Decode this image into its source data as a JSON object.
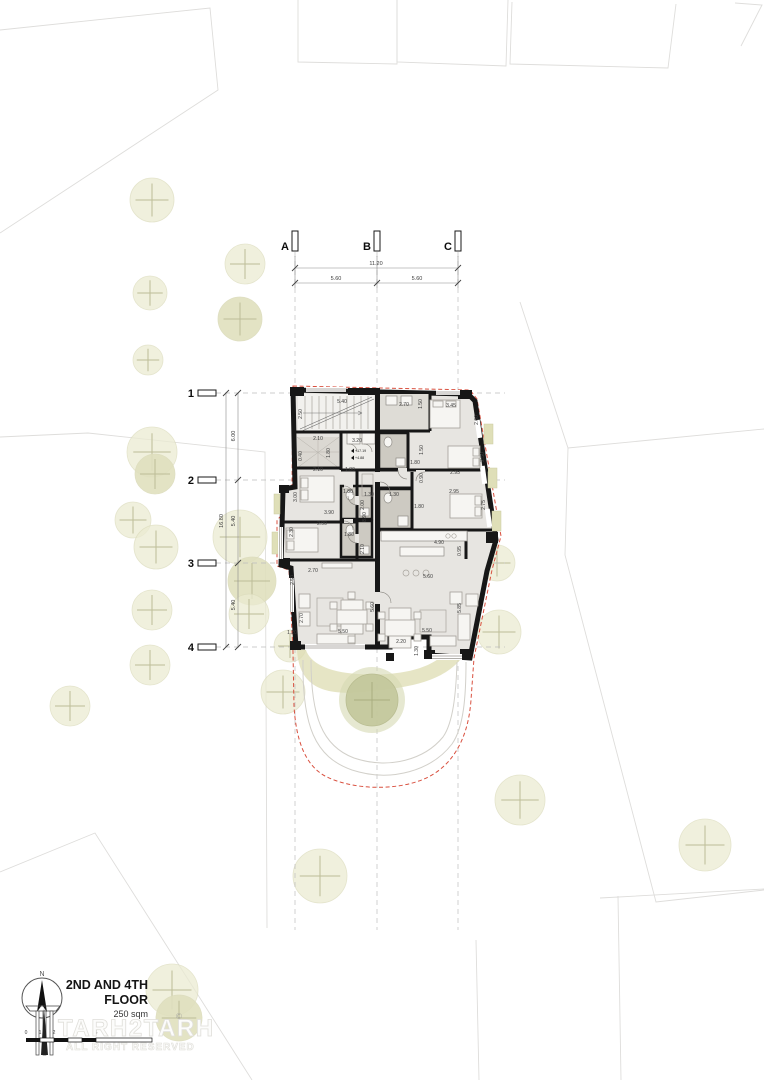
{
  "title_block": {
    "title_line1": "2ND AND 4TH",
    "title_line2": "FLOOR",
    "area": "250 sqm",
    "north_label": "N",
    "watermark_line1": "TARH2TARH",
    "watermark_line2": "ALL RIGHT RESERVED",
    "copyright": "©"
  },
  "scale_bar": {
    "labels": [
      {
        "t": "0",
        "x": 26
      },
      {
        "t": "1",
        "x": 40
      },
      {
        "t": "2",
        "x": 54
      },
      {
        "t": "5",
        "x": 96
      }
    ]
  },
  "grid": {
    "columns": [
      {
        "label": "A",
        "x": 295
      },
      {
        "label": "B",
        "x": 377
      },
      {
        "label": "C",
        "x": 458
      }
    ],
    "rows": [
      {
        "label": "1",
        "y": 393
      },
      {
        "label": "2",
        "y": 480
      },
      {
        "label": "3",
        "y": 563
      },
      {
        "label": "4",
        "y": 647
      }
    ]
  },
  "site_dimensions": {
    "top_total": "11.20",
    "top_segments": [
      "5.60",
      "5.60"
    ],
    "left_total": "16.80",
    "left_segments": [
      "6.00",
      "5.40",
      "5.40"
    ]
  },
  "plan_dimensions": [
    {
      "t": "5.40",
      "x": 342,
      "y": 403
    },
    {
      "t": "2.50",
      "x": 302,
      "y": 414,
      "r": 1
    },
    {
      "t": "2.70",
      "x": 404,
      "y": 406
    },
    {
      "t": "1.50",
      "x": 422,
      "y": 404,
      "r": 1
    },
    {
      "t": "3.45",
      "x": 451,
      "y": 407
    },
    {
      "t": "2.60",
      "x": 478,
      "y": 420,
      "r": 1
    },
    {
      "t": "2.10",
      "x": 318,
      "y": 440
    },
    {
      "t": "0.40",
      "x": 302,
      "y": 456,
      "r": 1
    },
    {
      "t": "1.80",
      "x": 330,
      "y": 453,
      "r": 1
    },
    {
      "t": "3.20",
      "x": 357,
      "y": 442
    },
    {
      "t": "2.10",
      "x": 318,
      "y": 471
    },
    {
      "t": "1.80",
      "x": 350,
      "y": 471
    },
    {
      "t": "1.50",
      "x": 423,
      "y": 450,
      "r": 1
    },
    {
      "t": "1.80",
      "x": 415,
      "y": 464
    },
    {
      "t": "2.50",
      "x": 484,
      "y": 457,
      "r": 1
    },
    {
      "t": "2.95",
      "x": 455,
      "y": 474
    },
    {
      "t": "0.90",
      "x": 423,
      "y": 478,
      "r": 1
    },
    {
      "t": "2.95",
      "x": 454,
      "y": 493
    },
    {
      "t": "2.75",
      "x": 485,
      "y": 505,
      "r": 1
    },
    {
      "t": "1.30",
      "x": 369,
      "y": 496
    },
    {
      "t": "1.30",
      "x": 394,
      "y": 496
    },
    {
      "t": "3.00",
      "x": 297,
      "y": 497,
      "r": 1
    },
    {
      "t": "1.80",
      "x": 348,
      "y": 493
    },
    {
      "t": "2.00",
      "x": 364,
      "y": 505,
      "r": 1
    },
    {
      "t": "8.90",
      "x": 366,
      "y": 517,
      "r": 1
    },
    {
      "t": "3.90",
      "x": 329,
      "y": 514
    },
    {
      "t": "2.90",
      "x": 322,
      "y": 525
    },
    {
      "t": "2.30",
      "x": 293,
      "y": 532,
      "r": 1
    },
    {
      "t": "1.80",
      "x": 349,
      "y": 536
    },
    {
      "t": "2.10",
      "x": 364,
      "y": 549,
      "r": 1
    },
    {
      "t": "1.80",
      "x": 419,
      "y": 508
    },
    {
      "t": "4.90",
      "x": 439,
      "y": 544
    },
    {
      "t": "0.95",
      "x": 461,
      "y": 551,
      "r": 1
    },
    {
      "t": "2.70",
      "x": 313,
      "y": 572
    },
    {
      "t": "2.50",
      "x": 294,
      "y": 580,
      "r": 1
    },
    {
      "t": "2.70",
      "x": 303,
      "y": 618,
      "r": 1
    },
    {
      "t": "5.60",
      "x": 374,
      "y": 607,
      "r": 1
    },
    {
      "t": "5.60",
      "x": 428,
      "y": 578
    },
    {
      "t": "5.85",
      "x": 461,
      "y": 608,
      "r": 1
    },
    {
      "t": "1.20",
      "x": 292,
      "y": 634
    },
    {
      "t": "5.50",
      "x": 343,
      "y": 633
    },
    {
      "t": "5.50",
      "x": 427,
      "y": 632
    },
    {
      "t": "2.20",
      "x": 401,
      "y": 643
    },
    {
      "t": "1.30",
      "x": 418,
      "y": 651,
      "r": 1
    }
  ],
  "elevation_markers": [
    {
      "t": "+17.19",
      "x": 355,
      "y": 452
    },
    {
      "t": "+4.88",
      "x": 355,
      "y": 459
    }
  ],
  "trees": [
    {
      "x": 152,
      "y": 200,
      "r": 22
    },
    {
      "x": 245,
      "y": 264,
      "r": 20
    },
    {
      "x": 150,
      "y": 293,
      "r": 17
    },
    {
      "x": 240,
      "y": 319,
      "r": 22,
      "d": 1
    },
    {
      "x": 148,
      "y": 360,
      "r": 15
    },
    {
      "x": 152,
      "y": 452,
      "r": 25
    },
    {
      "x": 155,
      "y": 474,
      "r": 20,
      "d": 1
    },
    {
      "x": 133,
      "y": 520,
      "r": 18
    },
    {
      "x": 156,
      "y": 547,
      "r": 22
    },
    {
      "x": 240,
      "y": 537,
      "r": 27
    },
    {
      "x": 252,
      "y": 581,
      "r": 24,
      "d": 1
    },
    {
      "x": 249,
      "y": 614,
      "r": 20
    },
    {
      "x": 152,
      "y": 610,
      "r": 20
    },
    {
      "x": 150,
      "y": 665,
      "r": 20
    },
    {
      "x": 70,
      "y": 706,
      "r": 20
    },
    {
      "x": 290,
      "y": 646,
      "r": 16
    },
    {
      "x": 283,
      "y": 692,
      "r": 22
    },
    {
      "x": 497,
      "y": 563,
      "r": 18
    },
    {
      "x": 499,
      "y": 632,
      "r": 22
    },
    {
      "x": 520,
      "y": 800,
      "r": 25
    },
    {
      "x": 705,
      "y": 845,
      "r": 26
    },
    {
      "x": 320,
      "y": 876,
      "r": 27
    },
    {
      "x": 172,
      "y": 990,
      "r": 26
    },
    {
      "x": 179,
      "y": 1018,
      "r": 23,
      "d": 1
    }
  ],
  "courtyard_tree": {
    "x": 372,
    "y": 700,
    "r": 26
  },
  "colors": {
    "boundary_red": "#d9503f",
    "wall": "#171717",
    "floor": "#e7e5e1",
    "bath_floor": "#cdcac2",
    "balcony_khaki": "#dfdfb8",
    "tree_fill": "#ebebd2",
    "olive_tree": "#c3c79b"
  }
}
